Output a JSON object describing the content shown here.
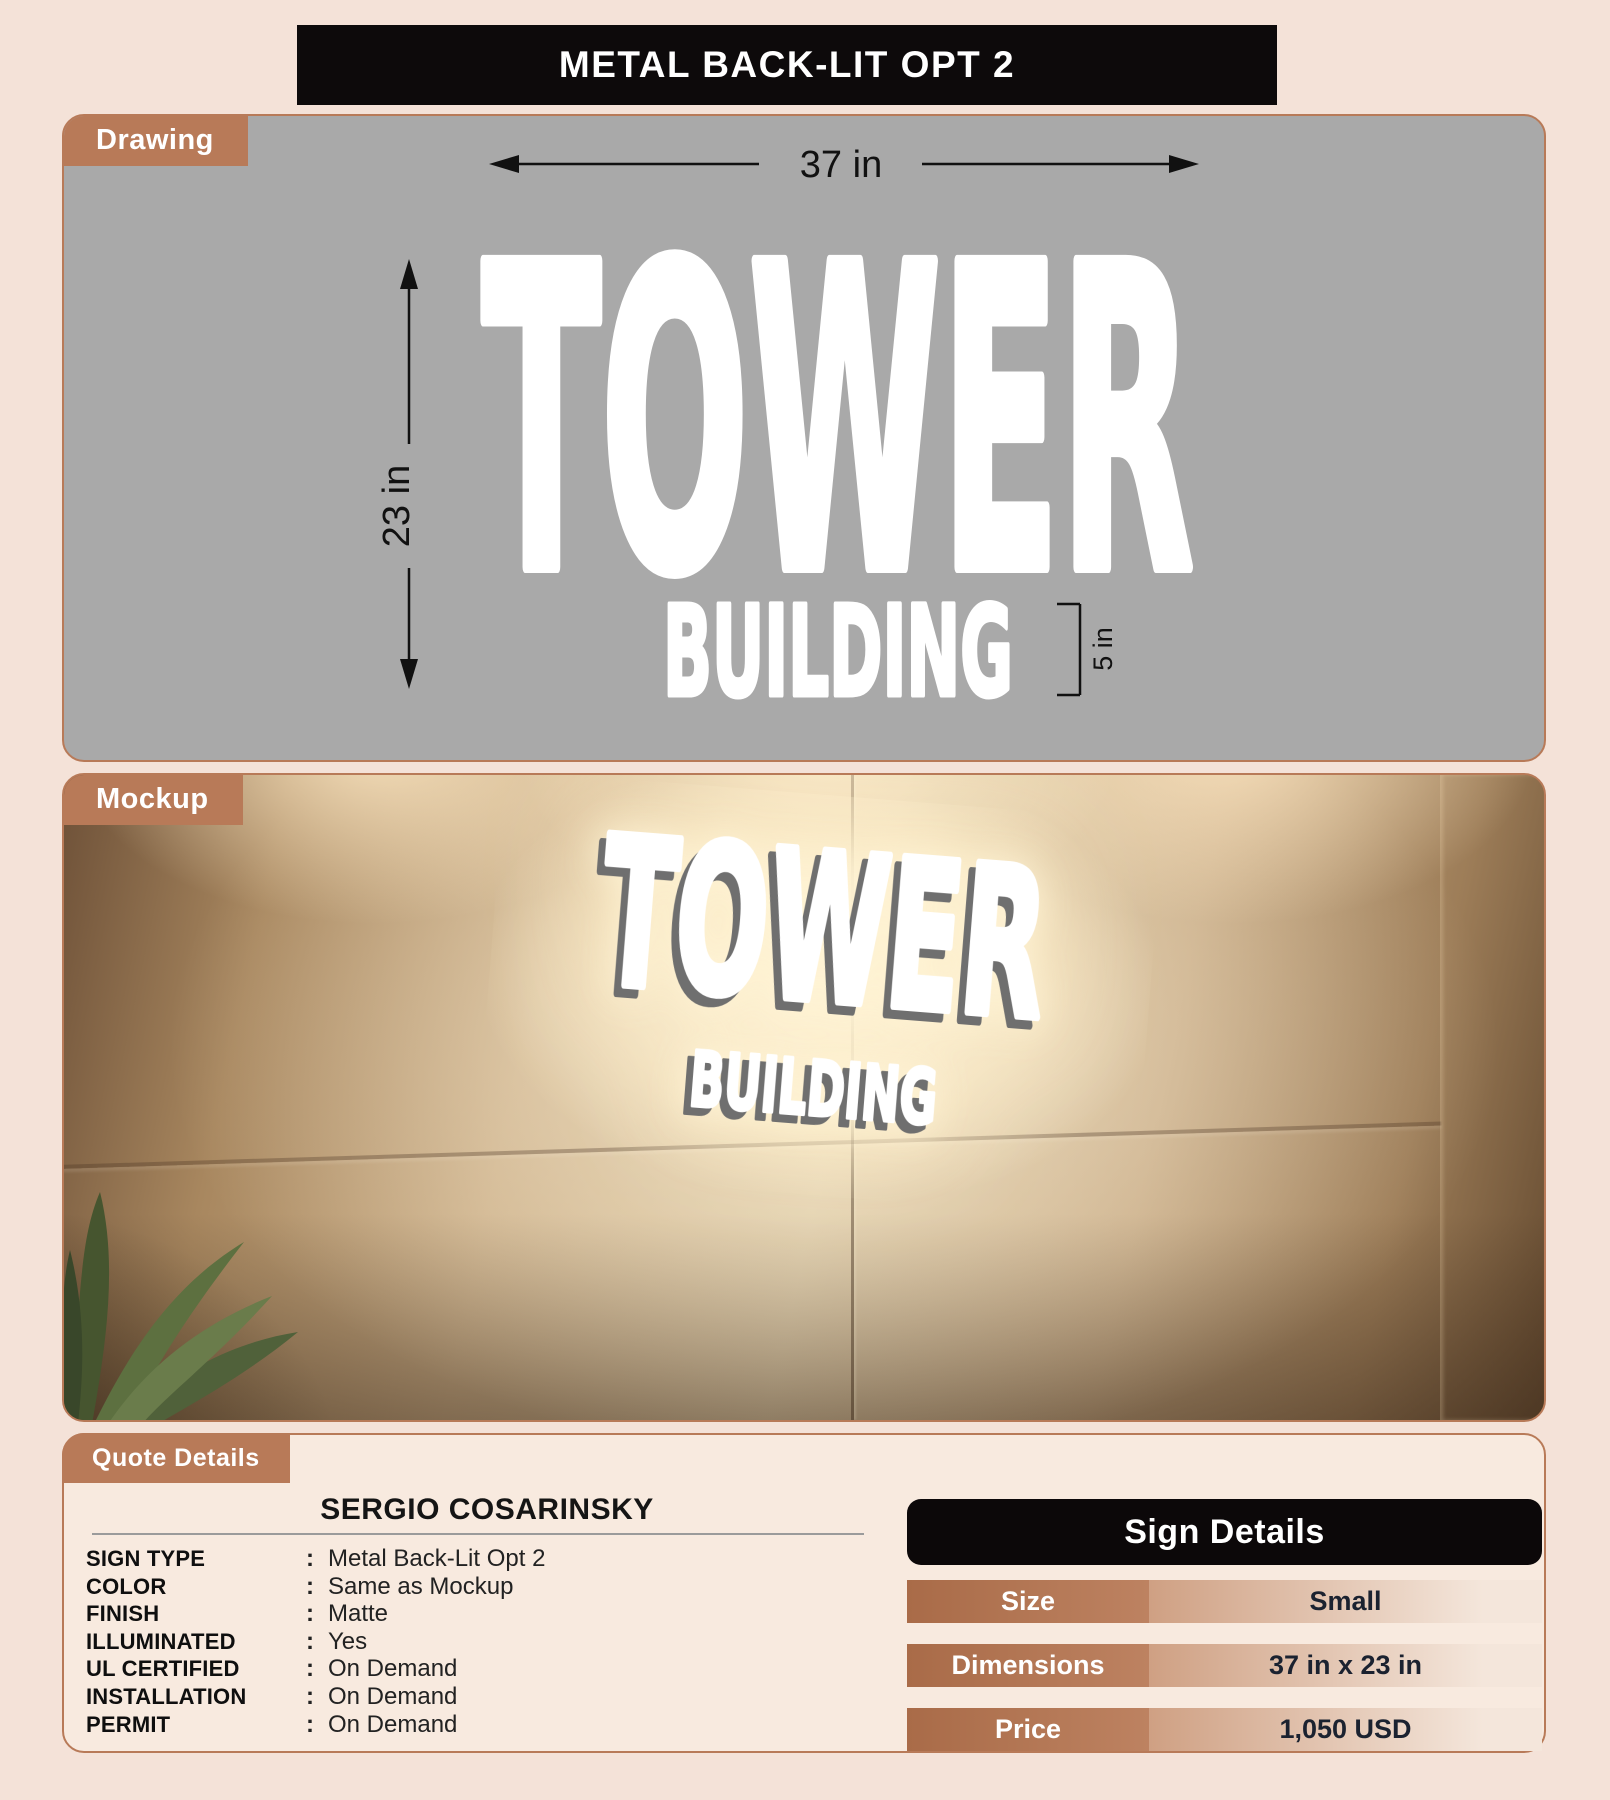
{
  "colors": {
    "page_bg": "#f4e2d8",
    "accent_copper": "#b87a58",
    "title_bar_black": "#0d0a0b",
    "drawing_bg": "#a9a9a9",
    "sign_glow": "#fff1d0",
    "detail_value_text": "#1b2230"
  },
  "header": {
    "title": "METAL BACK-LIT OPT 2"
  },
  "drawing": {
    "tab_label": "Drawing",
    "sign_line1": "TOWER",
    "sign_line2": "BUILDING",
    "width_dim": "37 in",
    "height_dim": "23 in",
    "line2_height_dim": "5 in"
  },
  "mockup": {
    "tab_label": "Mockup",
    "sign_line1": "TOWER",
    "sign_line2": "BUILDING"
  },
  "quote": {
    "tab_label": "Quote Details",
    "customer_name": "SERGIO COSARINSKY",
    "separator": ":",
    "fields": [
      {
        "label": "SIGN TYPE",
        "value": "Metal Back-Lit Opt 2"
      },
      {
        "label": "COLOR",
        "value": "Same as Mockup"
      },
      {
        "label": "FINISH",
        "value": "Matte"
      },
      {
        "label": "ILLUMINATED",
        "value": "Yes"
      },
      {
        "label": "UL CERTIFIED",
        "value": "On Demand"
      },
      {
        "label": "INSTALLATION",
        "value": "On Demand"
      },
      {
        "label": "PERMIT",
        "value": "On Demand"
      }
    ]
  },
  "sign_details": {
    "title": "Sign Details",
    "rows": [
      {
        "label": "Size",
        "value": "Small"
      },
      {
        "label": "Dimensions",
        "value": "37 in x 23 in"
      },
      {
        "label": "Price",
        "value": "1,050 USD"
      }
    ]
  }
}
